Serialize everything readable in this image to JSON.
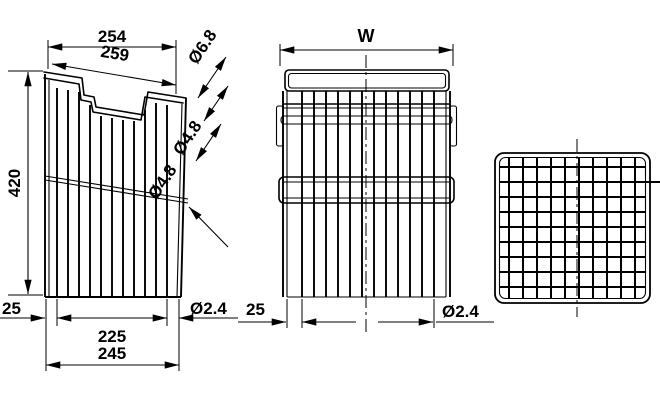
{
  "drawing": {
    "side_view": {
      "top_width": "254",
      "rim_width": "259",
      "height": "420",
      "bottom_inset": "25",
      "wire_span": "225",
      "bottom_width": "245",
      "rim_wire_dia": "Ø6.8",
      "upper_wire_dia": "Ø4.8",
      "cross_wire_dia": "Ø4.8",
      "mesh_wire_dia": "Ø2.4"
    },
    "front_view": {
      "width": "W",
      "bottom_inset": "25",
      "mesh_wire_dia": "Ø2.4"
    },
    "colors": {
      "line": "#000000",
      "background": "#ffffff"
    }
  }
}
